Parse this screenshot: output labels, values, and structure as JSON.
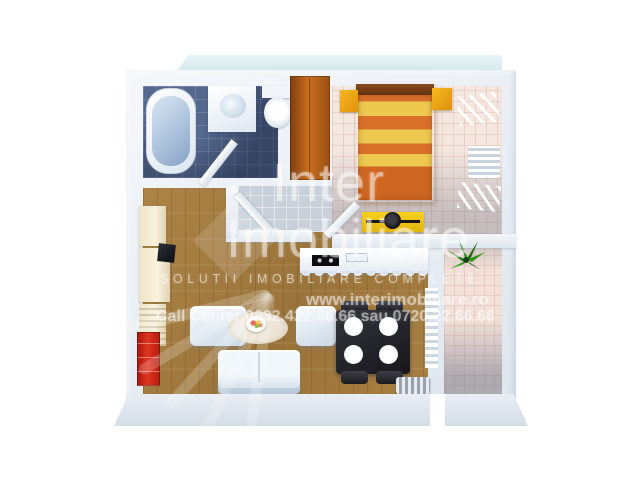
{
  "watermark": {
    "brand_line1": "Inter",
    "brand_line2": "Imobiliare",
    "registered_mark": "®",
    "tagline": "SOLUTII IMOBILIARE COMPLETE",
    "website": "www.interimobiliare.ro",
    "phone_line": "Call Center 0232.422.66.66 sau 0720.22.66.66"
  },
  "colors": {
    "background": "#ffffff",
    "wall": "#e7edf3",
    "terrace_strip": "#dceef0",
    "bathroom_floor": "#55698e",
    "bedroom_floor": "#f5e7e0",
    "hall_floor": "#c8d0da",
    "living_floor": "#a17a3e",
    "balcony_floor": "#f3e0d8",
    "bed_orange": "#d9702a",
    "bed_yellow": "#edc94f",
    "nightstand_yellow": "#f2a91c",
    "wardrobe_wood": "#b06018",
    "vanity_yellow": "#eec617",
    "red_cabinet": "#c62418",
    "dining_set_dark": "#25252b",
    "plant_green": "#2e8022",
    "watermark_white": "rgba(255,255,255,0.45)"
  },
  "scene": {
    "type": "3d-apartment-floorplan-render",
    "rooms": [
      {
        "name": "bathroom",
        "furniture": [
          "bathtub",
          "washbasin",
          "toilet",
          "door"
        ]
      },
      {
        "name": "bedroom",
        "furniture": [
          "wardrobe",
          "double-bed",
          "nightstand-left",
          "nightstand-right",
          "wall-shelves",
          "vanity-desk",
          "stool",
          "door"
        ]
      },
      {
        "name": "hallway",
        "furniture": [
          "door"
        ]
      },
      {
        "name": "living-room-kitchen",
        "furniture": [
          "kitchen-counter",
          "cooktop",
          "sink",
          "wall-unit",
          "tv",
          "red-cabinet",
          "armchair",
          "armchair",
          "rug",
          "food-plate",
          "sofa",
          "dining-table",
          "dining-chairs",
          "radiator",
          "radiator-panel"
        ]
      },
      {
        "name": "balcony",
        "furniture": [
          "plant"
        ]
      }
    ]
  }
}
